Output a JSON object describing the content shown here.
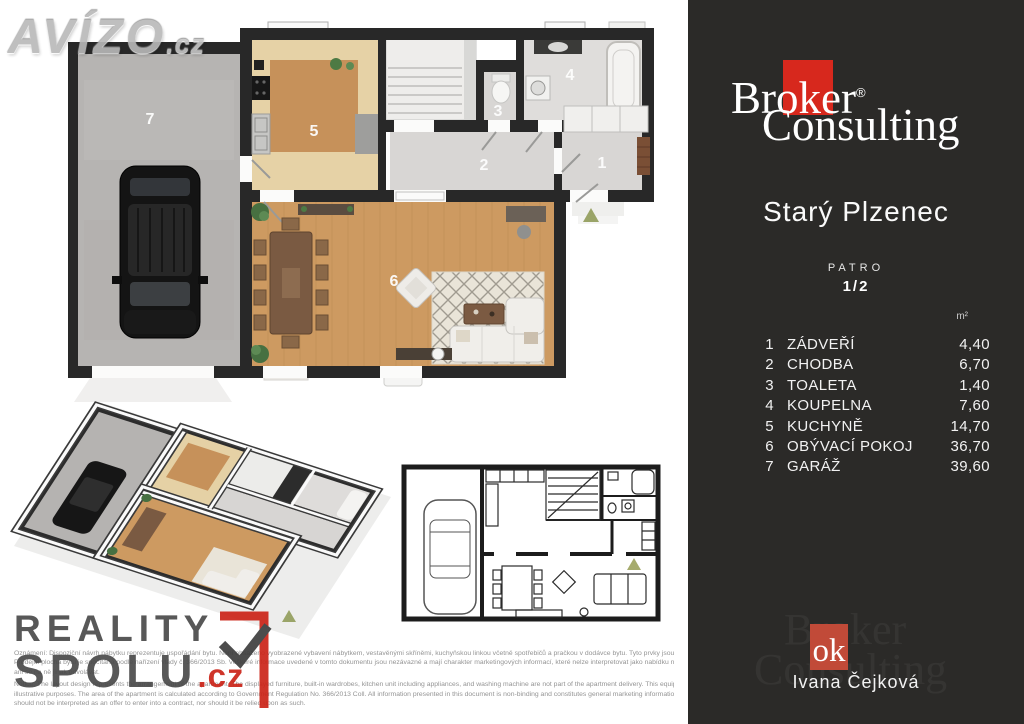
{
  "avizo": {
    "name": "AVÍZO",
    "tld": ".cz"
  },
  "plan_labels": [
    "1",
    "2",
    "3",
    "4",
    "5",
    "6",
    "7"
  ],
  "sidebar": {
    "brand": {
      "word1": "Broker",
      "reg": "®",
      "word2": "Consulting"
    },
    "location": "Starý Plzenec",
    "floor_label": "PATRO",
    "floor_value": "1/2",
    "unit": "m²",
    "rooms": [
      {
        "num": "1",
        "name": "ZÁDVEŘÍ",
        "area": "4,40"
      },
      {
        "num": "2",
        "name": "CHODBA",
        "area": "6,70"
      },
      {
        "num": "3",
        "name": "TOALETA",
        "area": "1,40"
      },
      {
        "num": "4",
        "name": "KOUPELNA",
        "area": "7,60"
      },
      {
        "num": "5",
        "name": "KUCHYNĚ",
        "area": "14,70"
      },
      {
        "num": "6",
        "name": "OBÝVACÍ POKOJ",
        "area": "36,70"
      },
      {
        "num": "7",
        "name": "GARÁŽ",
        "area": "39,60"
      }
    ],
    "agent": {
      "logo": "ok",
      "name": "Ivana Čejková",
      "ghost1": "Broker",
      "ghost2": "Consulting"
    }
  },
  "footer": {
    "logo": {
      "line1": "REALITY",
      "line2": "SPOLU",
      "tld": ".cz"
    },
    "disclaimer_cz_1": "Oznámení: Dispoziční návrh nábytku reprezentuje uspořádání bytu. Není obsaženo vyobrazené vybavení nábytkem, vestavěnými skříněmi, kuchyňskou linkou včetně spotřebičů a pračkou v dodávce bytu. Tyto prvky jsou pouze ilustrační.",
    "disclaimer_cz_2": "Prodejní plocha bytu je spočítána podle nařízení vlády č. 366/2013 Sb. Veškeré informace uvedené v tomto dokumentu jsou nezávazné a mají charakter marketingových informací, které nelze interpretovat jako nabídku na uzavření smlouvy,",
    "disclaimer_cz_3": "ani se na ně jinak odvolávat.",
    "disclaimer_en_1": "Notice: The layout design represents the arrangement of the apartment. The displayed furniture, built-in wardrobes, kitchen unit including appliances, and washing machine are not part of the apartment delivery. This equipment is shown for",
    "disclaimer_en_2": "illustrative purposes. The area of the apartment is calculated according to Government Regulation No. 366/2013 Coll. All information presented in this document is non-binding and constitutes general marketing information, which",
    "disclaimer_en_3": "should not be interpreted as an offer to enter into a contract, nor should it be relied upon as such."
  },
  "colors": {
    "brand_red": "#d7281d",
    "agent_red": "#c14a38",
    "sidebar_bg": "#2b2a28",
    "wall": "#282828",
    "wood": "#cd9a61",
    "garage_floor": "#b6b4b2",
    "hall_floor": "#d8d6d4",
    "kitchen_tile": "#e6d2a6",
    "accent_green": "#9aa468"
  }
}
